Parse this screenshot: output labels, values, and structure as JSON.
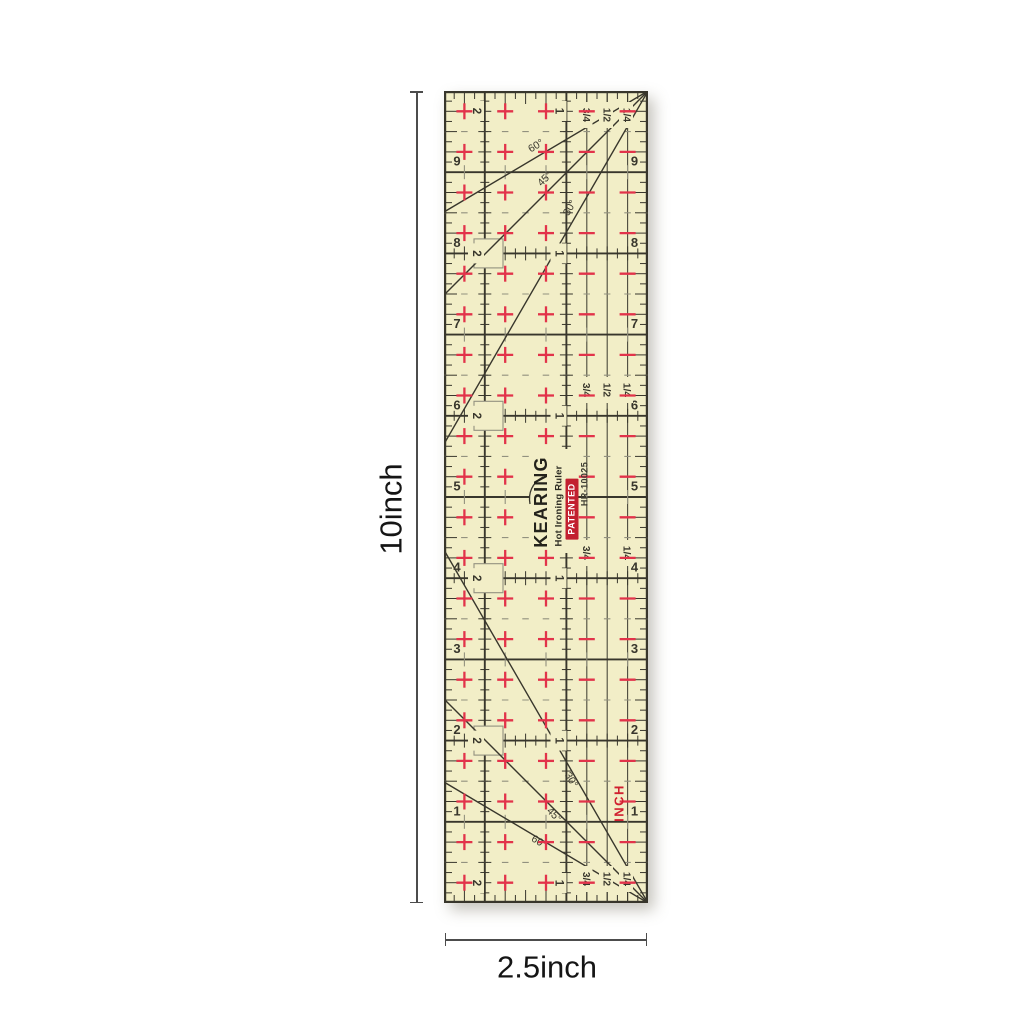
{
  "annotations": {
    "height": "10inch",
    "width": "2.5inch"
  },
  "ruler": {
    "brand": "KEARING",
    "product": "Hot Ironing Ruler",
    "badge": "PATENTED",
    "model": "HR-10025",
    "unit": "INCH",
    "size": {
      "width_in": 2.5,
      "height_in": 10
    },
    "edge_numbers": [
      "9",
      "8",
      "7",
      "6",
      "5",
      "4",
      "3",
      "2",
      "1"
    ],
    "column_labels": [
      "2",
      "1"
    ],
    "fraction_labels": [
      "3/4",
      "1/2",
      "1/4"
    ],
    "angle_labels": [
      "60°",
      "45°",
      "30°"
    ],
    "colors": {
      "body": "#f2eec7",
      "grid": "#38362c",
      "grid_light": "#4a483c",
      "minor": "#92917f",
      "cross": "#e2334a",
      "badge_bg": "#c2202f",
      "badge_text": "#ffffff",
      "unit_text": "#d0202f"
    }
  }
}
